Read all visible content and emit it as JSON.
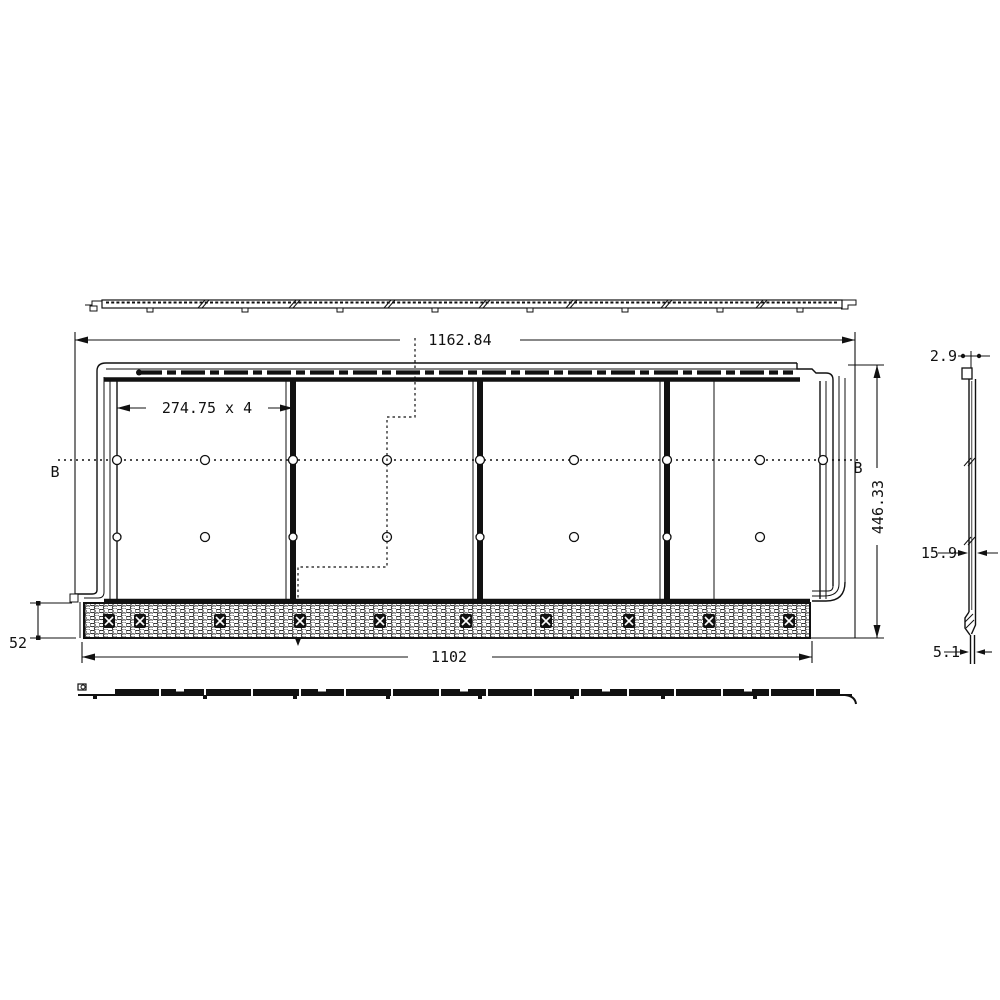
{
  "meta": {
    "background": "#ffffff",
    "ink": "#111111",
    "drawing_type": "panel fabrication drawing, four views"
  },
  "front_view": {
    "section_label_left": "B",
    "section_label_right": "B",
    "panel_count": 4,
    "hole_rows": 2,
    "fastener_count": 10
  },
  "dimensions": {
    "overall_width": "1162.84",
    "module_pitch": "274.75 x 4",
    "overall_height": "446.33",
    "base_strip_height": "52",
    "base_width": "1102",
    "edge_thickness_top": "2.9",
    "profile_thickness": "15.9",
    "edge_thickness_bottom": "5.1"
  }
}
